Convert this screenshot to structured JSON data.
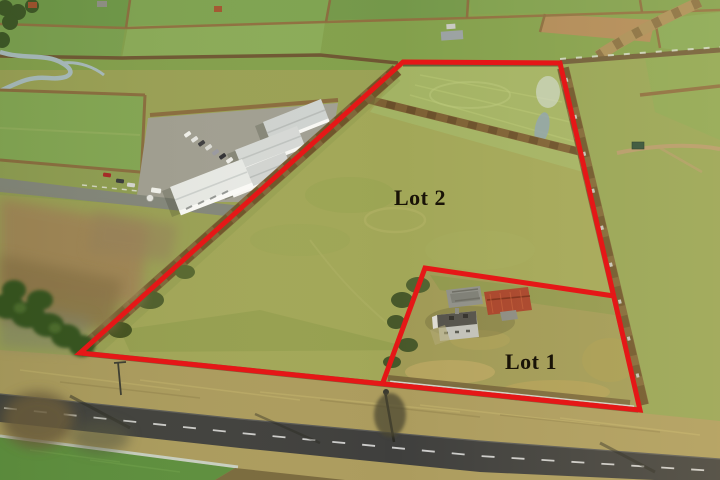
{
  "document": {
    "title": "Aerial photograph of farmland offered for sale in two lots"
  },
  "annotations": {
    "boundary_color": "#e51717",
    "boundary_width": 5,
    "outer_boundary_points": "403,62 560,63 640,410 80,353",
    "lot_divider_points": "614,296 425,268 382,385",
    "label_color": "#191307",
    "label_font_size": 22,
    "lot2": {
      "label": "Lot 2",
      "x": 420,
      "y": 205
    },
    "lot1": {
      "label": "Lot 1",
      "x": 531,
      "y": 369
    }
  },
  "palette": {
    "field_green": "#9aa155",
    "bright_field_green": "#5c8f3d",
    "hedgerow_brown": "#7c6036",
    "road_asphalt": "#3f3f3d",
    "frost_white": "#ccd7d3",
    "barn_roof_red": "#a8432a",
    "warehouse_roof_grey": "#d6d9d7"
  }
}
